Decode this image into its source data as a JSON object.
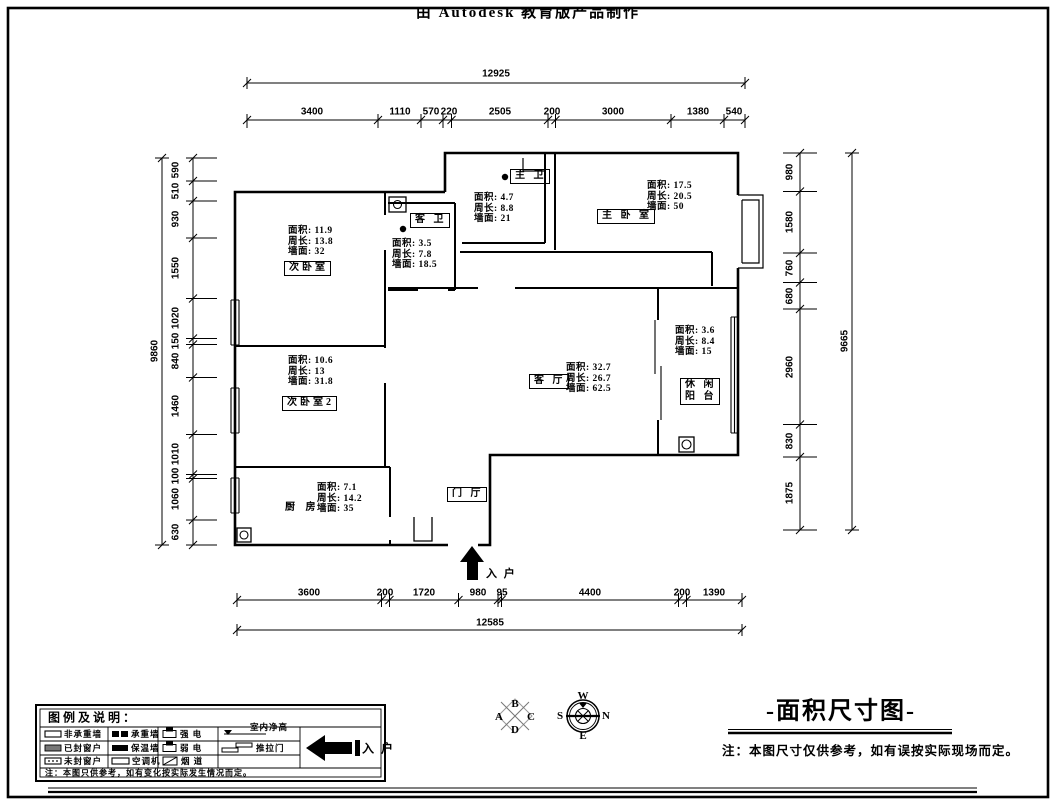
{
  "page": {
    "clipped_title": "由 Autodesk 教育版产品制作",
    "sheet_title": "-面积尺寸图-",
    "sheet_note": "注：本图尺寸仅供参考，如有误按实际现场而定。",
    "entry_label": "入 户"
  },
  "rooms": {
    "bedroom2": {
      "name": "次卧室",
      "stats": "面积:   11.9\n周长:  13.8\n墙面:   32"
    },
    "bedroom3": {
      "name": "次卧室2",
      "stats": "面积:  10.6\n周长:  13\n墙面:   31.8"
    },
    "kitchen": {
      "name": "厨 房",
      "stats": "面积:   7.1\n周长:  14.2\n墙面:   35"
    },
    "guest_bath": {
      "name": "客 卫",
      "stats": "面积:   3.5\n周长:  7.8\n墙面:   18.5"
    },
    "master_bath": {
      "name": "主 卫",
      "stats": "面积:   4.7\n周长:  8.8\n墙面:  21"
    },
    "master_bedroom": {
      "name": "主 卧 室",
      "stats": "面积:   17.5\n周长:  20.5\n墙面:  50"
    },
    "living": {
      "name": "客 厅",
      "stats": "面积:   32.7\n周长:  26.7\n墙面:   62.5"
    },
    "balcony": {
      "name": "休 闲\n阳 台",
      "stats": "面积:   3.6\n周长:  8.4\n墙面:  15"
    },
    "foyer": {
      "name": "门 厅"
    }
  },
  "dims": {
    "top": {
      "total": "12925",
      "segments": [
        "3400",
        "1110",
        "570",
        "220",
        "2505",
        "200",
        "3000",
        "1380",
        "540"
      ]
    },
    "bottom": {
      "total": "12585",
      "segments": [
        "3600",
        "200",
        "1720",
        "980",
        "95",
        "4400",
        "200",
        "1390"
      ]
    },
    "left": {
      "total": "9860",
      "segments": [
        "590",
        "510",
        "930",
        "1550",
        "1020",
        "150",
        "840",
        "1460",
        "1010",
        "100",
        "1060",
        "630"
      ]
    },
    "right": {
      "total": "9665",
      "segments": [
        "980",
        "1580",
        "760",
        "680",
        "2960",
        "830",
        "1875"
      ]
    }
  },
  "legend": {
    "title": "图例及说明：",
    "items": [
      "非承重墙",
      "承重墙",
      "强  电",
      "室内净高",
      "已封窗户",
      "保温墙",
      "弱  电",
      "推拉门",
      "未封窗户",
      "空调机",
      "烟  道"
    ],
    "entry": "入 户",
    "note": "注：本图只供参考，如有变化按实际发生情况而定。"
  },
  "compass": {
    "quad": {
      "top": "B",
      "left": "A",
      "right": "C",
      "bottom": "D"
    },
    "rose": {
      "top": "W",
      "left": "S",
      "right": "N",
      "bottom": "E"
    }
  }
}
